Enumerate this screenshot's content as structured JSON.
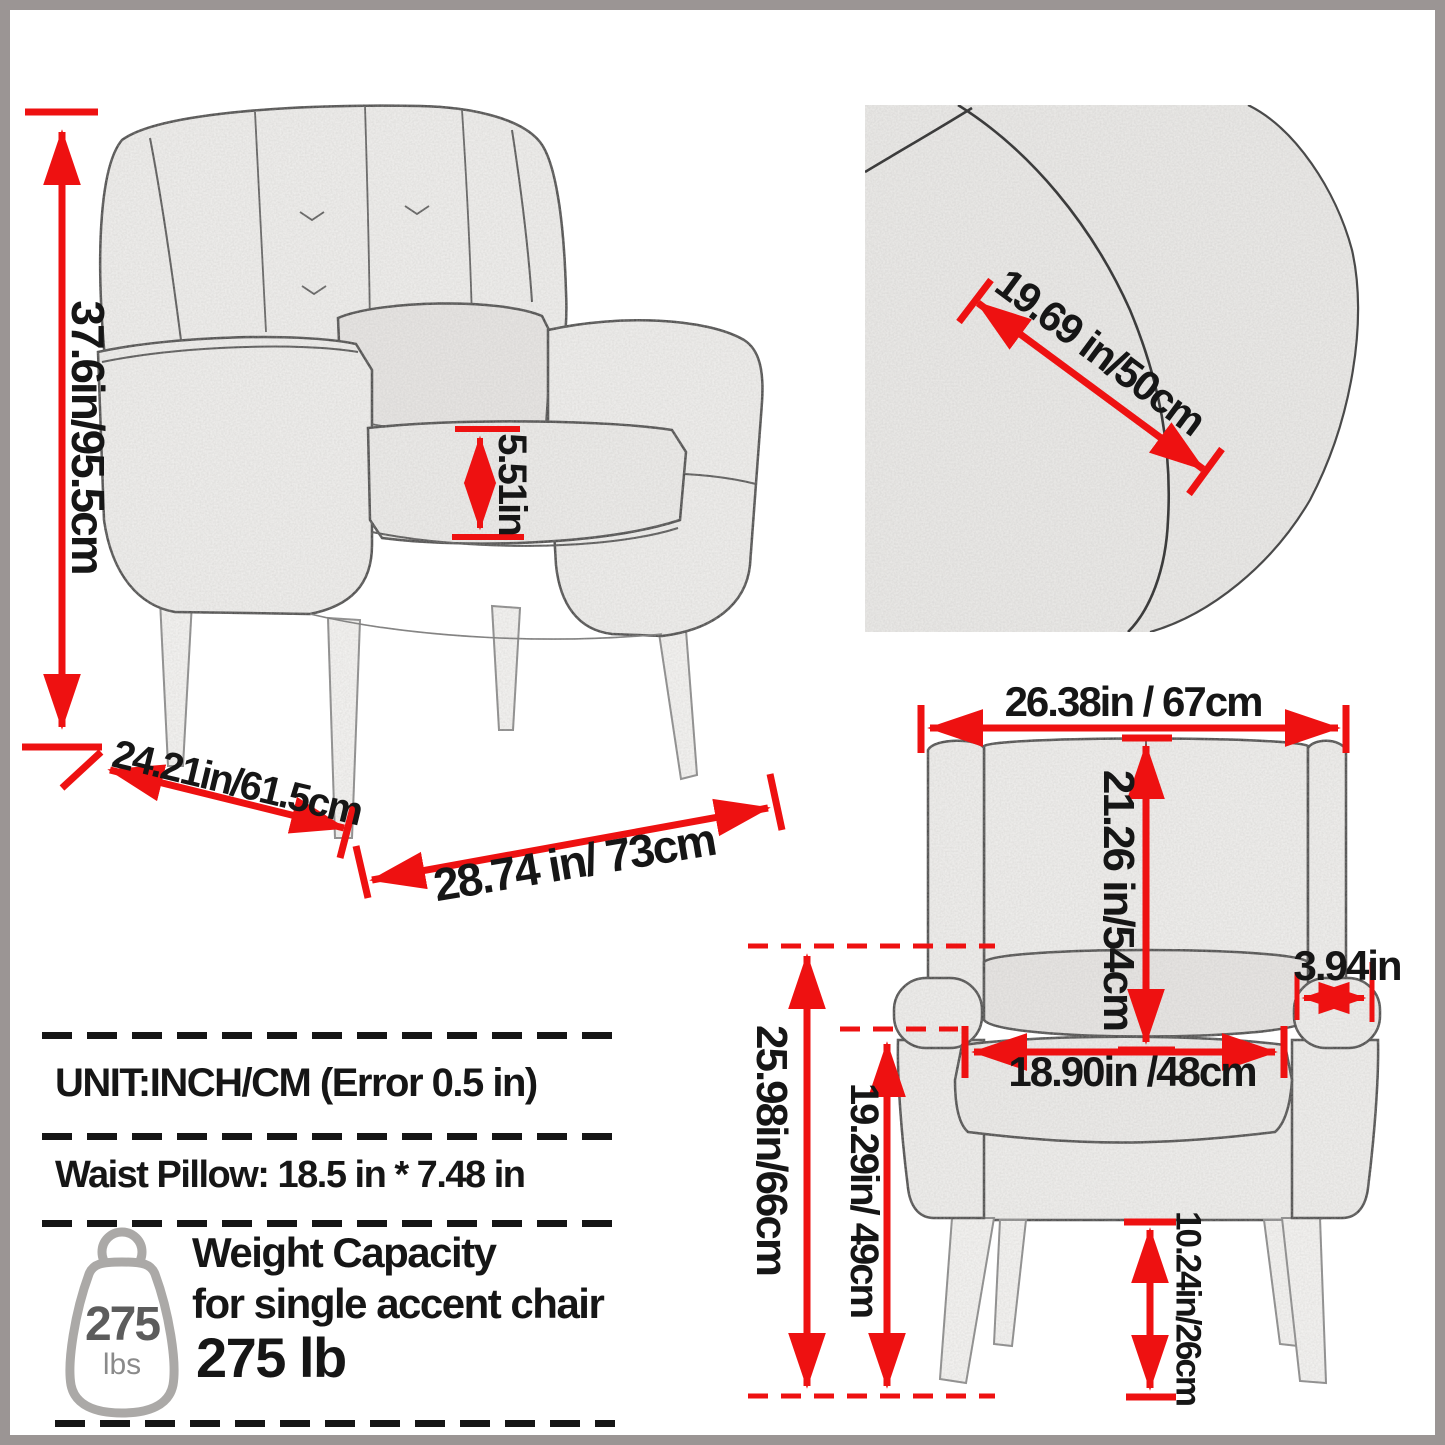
{
  "meta": {
    "type": "product-dimension-diagram",
    "subject": "accent chair"
  },
  "colors": {
    "accent_red": "#ee1111",
    "frame_gray": "#9b9594",
    "text": "#161616"
  },
  "perspective_view": {
    "height": "37.6in/95.5cm",
    "seat_cushion_thickness": "5.51in",
    "depth": "24.21in/61.5cm",
    "width": "28.74 in/ 73cm"
  },
  "closeup_view": {
    "back_width": "19.69 in/50cm"
  },
  "front_view": {
    "overall_width": "26.38in / 67cm",
    "backrest_height": "21.26 in/54cm",
    "armrest_width": "3.94in",
    "seat_width": "18.90in /48cm",
    "armrest_height": "25.98in/66cm",
    "seat_height": "19.29in/ 49cm",
    "leg_height": "10.24in/26cm"
  },
  "info_panel": {
    "unit_line": "UNIT:INCH/CM (Error 0.5 in)",
    "pillow_line": "Waist Pillow: 18.5 in * 7.48 in",
    "weight_capacity": {
      "line1": "Weight Capacity",
      "line2": "for single accent chair",
      "line3": "275 lb"
    },
    "weight_icon": {
      "value": "275",
      "unit": "lbs"
    }
  }
}
